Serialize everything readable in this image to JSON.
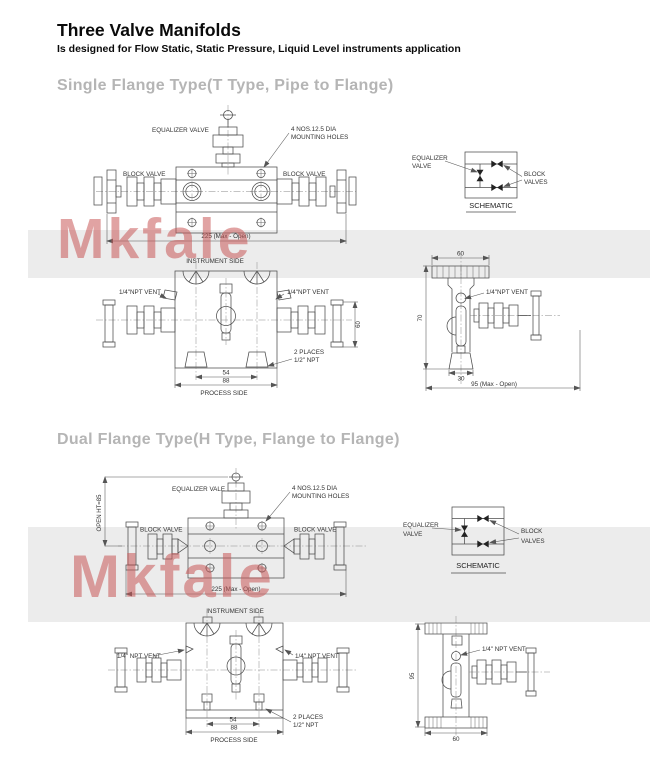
{
  "page": {
    "title": "Three Valve Manifolds",
    "subtitle": "Is designed for Flow Static, Static Pressure, Liquid Level instruments application",
    "watermark": "Mkfale"
  },
  "colors": {
    "watermark": "#c95858",
    "band": "#ececec",
    "heading": "#b5b5b5",
    "line": "#4d4d4d"
  },
  "single": {
    "heading": "Single Flange Type(T Type, Pipe to Flange)",
    "front": {
      "equalizer": "EQUALIZER VALVE",
      "mounting1": "4 NOS.12.5 DIA",
      "mounting2": "MOUNTING HOLES",
      "block_left": "BLOCK VALVE",
      "block_right": "BLOCK VALVE",
      "dim_width": "225 (Max - Open)"
    },
    "schematic": {
      "eq1": "EQUALIZER",
      "eq2": "VALVE",
      "blk1": "BLOCK",
      "blk2": "VALVES",
      "caption": "SCHEMATIC"
    },
    "bottom": {
      "instrument": "INSTRUMENT SIDE",
      "vent_left": "1/4\"NPT VENT",
      "vent_right": "1/4\"NPT VENT",
      "dim_a": "54",
      "dim_b": "88",
      "dim_c": "60",
      "places1": "2 PLACES",
      "places2": "1/2\" NPT",
      "process": "PROCESS SIDE"
    },
    "side": {
      "dim_top": "60",
      "dim_left": "70",
      "dim_bottom": "30",
      "dim_total": "95 (Max - Open)",
      "vent": "1/4\"NPT VENT"
    }
  },
  "dual": {
    "heading": "Dual Flange Type(H Type, Flange to Flange)",
    "front": {
      "open_ht": "OPEN HT=85",
      "equalizer": "EQUALIZER  VALE",
      "mounting1": "4 NOS.12.5  DIA",
      "mounting2": "MOUNTING HOLES",
      "block_left": "BLOCK  VALVE",
      "block_right": "BLOCK  VALVE",
      "dim_width": "225 (Max - Open)"
    },
    "schematic": {
      "eq1": "EQUALIZER",
      "eq2": "VALVE",
      "blk1": "BLOCK",
      "blk2": "VALVES",
      "caption": "SCHEMATIC"
    },
    "bottom": {
      "instrument": "INSTRUMENT SIDE",
      "vent_left": "1/4\" NPT VENT",
      "vent_right": "1/4\" NPT VENT",
      "dim_a": "54",
      "dim_b": "88",
      "places1": "2 PLACES",
      "places2": "1/2\" NPT",
      "process": "PROCESS SIDE"
    },
    "side": {
      "dim_left": "95",
      "dim_bottom": "60",
      "vent": "1/4\" NPT VENT"
    }
  }
}
